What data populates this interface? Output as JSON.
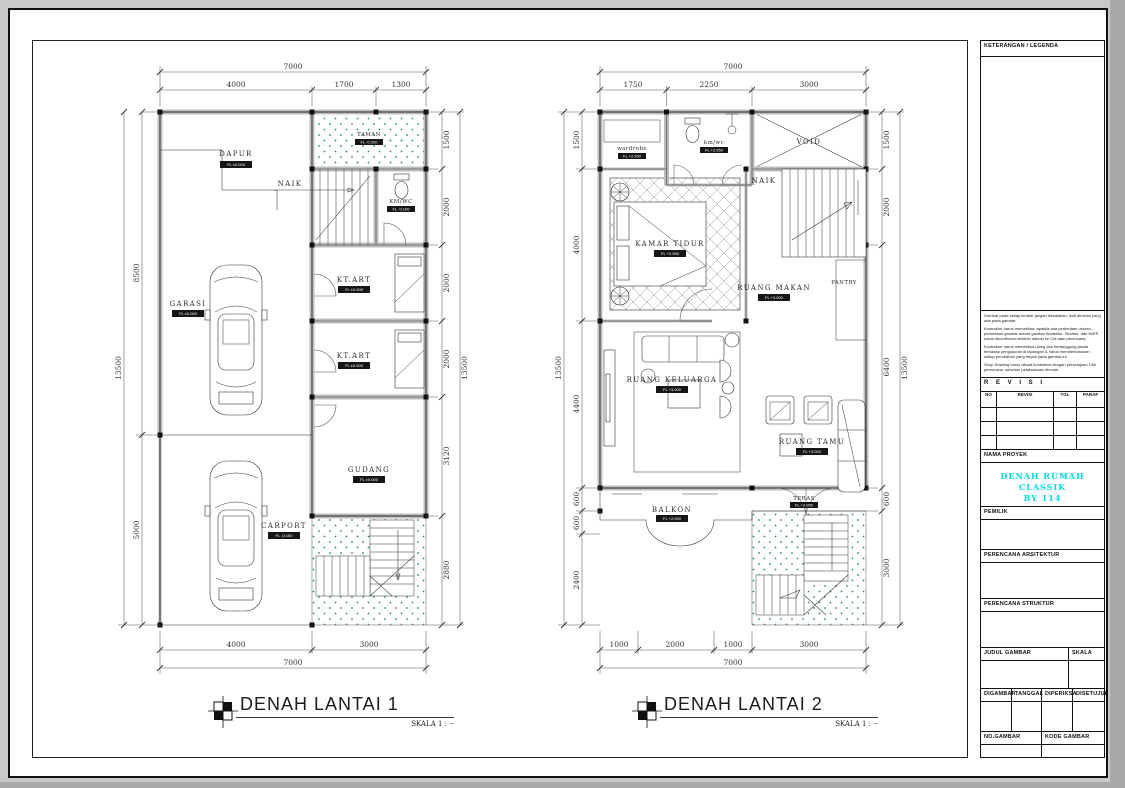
{
  "colors": {
    "accent_cyan": "#00DEDE",
    "garden_dot_green": "#2F8A57",
    "wall_gray": "#BDBDBD",
    "line_black": "#1A1A1A"
  },
  "title_block": {
    "legend_header": "KETERANGAN / LEGENDA",
    "notes": [
      "Gambar pada setiap lembar jangan diskalakan, ikuti dimensi yang ada pada gambar.",
      "Kontraktor harus memeriksa, apabila ada perbedaan ukuran, perbedaan gambar antara gambar Arsitektur, Struktur, dan M/EP, harus dikonfirmasi terlebih dahulu ke CM atau perencana.",
      "Kontraktor harus memeriksa ulang dan bertanggung jawab terhadap pengukuran di lapangan & harus memberitahukan setiap perubahan yang terjadi pada gambar ini.",
      "Shop Drawing harus dibuat kontraktor dengan persetujuan CM/ perencana, sebelum pelaksanaan dimulai."
    ],
    "revisi_header": "R E V I S I",
    "revisi_cols": [
      "NO",
      "REVISI",
      "TGL",
      "PARAF"
    ],
    "nama_proyek": "NAMA PROYEK",
    "project_name_line1": "DENAH RUMAH CLASSIK",
    "project_name_line2": "BY 114",
    "pemilik": "PEMILIK",
    "perencana_arsitektur": "PERENCANA ARSITEKTUR",
    "perencana_struktur": "PERENCANA STRUKTUR",
    "judul_gambar": "JUDUL GAMBAR",
    "skala": "SKALA",
    "digambar": "DIGAMBAR",
    "tanggal": "TANGGAL",
    "diperiksa": "DIPERIKSA",
    "disetujui": "DISETUJUI",
    "no_gambar": "NO.GAMBAR",
    "kode_gambar": "KODE GAMBAR"
  },
  "plan1": {
    "title": "DENAH LANTAI 1",
    "scale_note": "SKALA 1 : --",
    "rooms": {
      "dapur": {
        "label": "DAPUR",
        "level": "FL ±0.000"
      },
      "taman": {
        "label": "TAMAN",
        "level": "FL -0.200"
      },
      "naik": "NAIK",
      "kmwc": {
        "label": "KM/WC",
        "level": "FL -0.100"
      },
      "ktart1": {
        "label": "KT.ART",
        "level": "FL ±0.000"
      },
      "ktart2": {
        "label": "KT.ART",
        "level": "FL ±0.000"
      },
      "garasi": {
        "label": "GARASI",
        "level": "FL ±0.000"
      },
      "gudang": {
        "label": "GUDANG",
        "level": "FL ±0.000"
      },
      "carport": {
        "label": "CARPORT",
        "level": "FL -0.150"
      }
    },
    "dims": {
      "top_total": "7000",
      "top": [
        "4000",
        "1700",
        "1300"
      ],
      "left_total": "13500",
      "left": [
        "8500",
        "5000"
      ],
      "right": [
        "1500",
        "2000",
        "2000",
        "2000",
        "3120",
        "2880"
      ],
      "right_total": "13500",
      "bottom": [
        "4000",
        "3000"
      ],
      "bottom_total": "7000"
    }
  },
  "plan2": {
    "title": "DENAH LANTAI 2",
    "scale_note": "SKALA 1 : --",
    "rooms": {
      "wardrobe": {
        "label": "wardrobe",
        "level": "FL +2.950"
      },
      "kmwc": {
        "label": "km/wc",
        "level": "FL +2.950"
      },
      "void": "VOID",
      "naik": "NAIK",
      "kamar_tidur": {
        "label": "KAMAR TIDUR",
        "level": "FL +2.950"
      },
      "ruang_makan": {
        "label": "RUANG MAKAN",
        "level": "FL +3.000"
      },
      "pantry": "PANTRY",
      "ruang_keluarga": {
        "label": "RUANG KELUARGA",
        "level": "FL +3.000"
      },
      "ruang_tamu": {
        "label": "RUANG TAMU",
        "level": "FL +3.000"
      },
      "teras": {
        "label": "TERAS",
        "level": "FL +2.950"
      },
      "balkon": {
        "label": "BALKON",
        "level": "FL +2.950"
      }
    },
    "dims": {
      "top_total": "7000",
      "top": [
        "1750",
        "2250",
        "3000"
      ],
      "left_total": "13500",
      "left": [
        "1500",
        "4000",
        "4400",
        "600",
        "600",
        "2400"
      ],
      "right": [
        "1500",
        "2000",
        "6400",
        "600",
        "3000"
      ],
      "right_total": "13500",
      "bottom": [
        "1000",
        "2000",
        "1000",
        "3000"
      ],
      "bottom_total": "7000"
    }
  }
}
